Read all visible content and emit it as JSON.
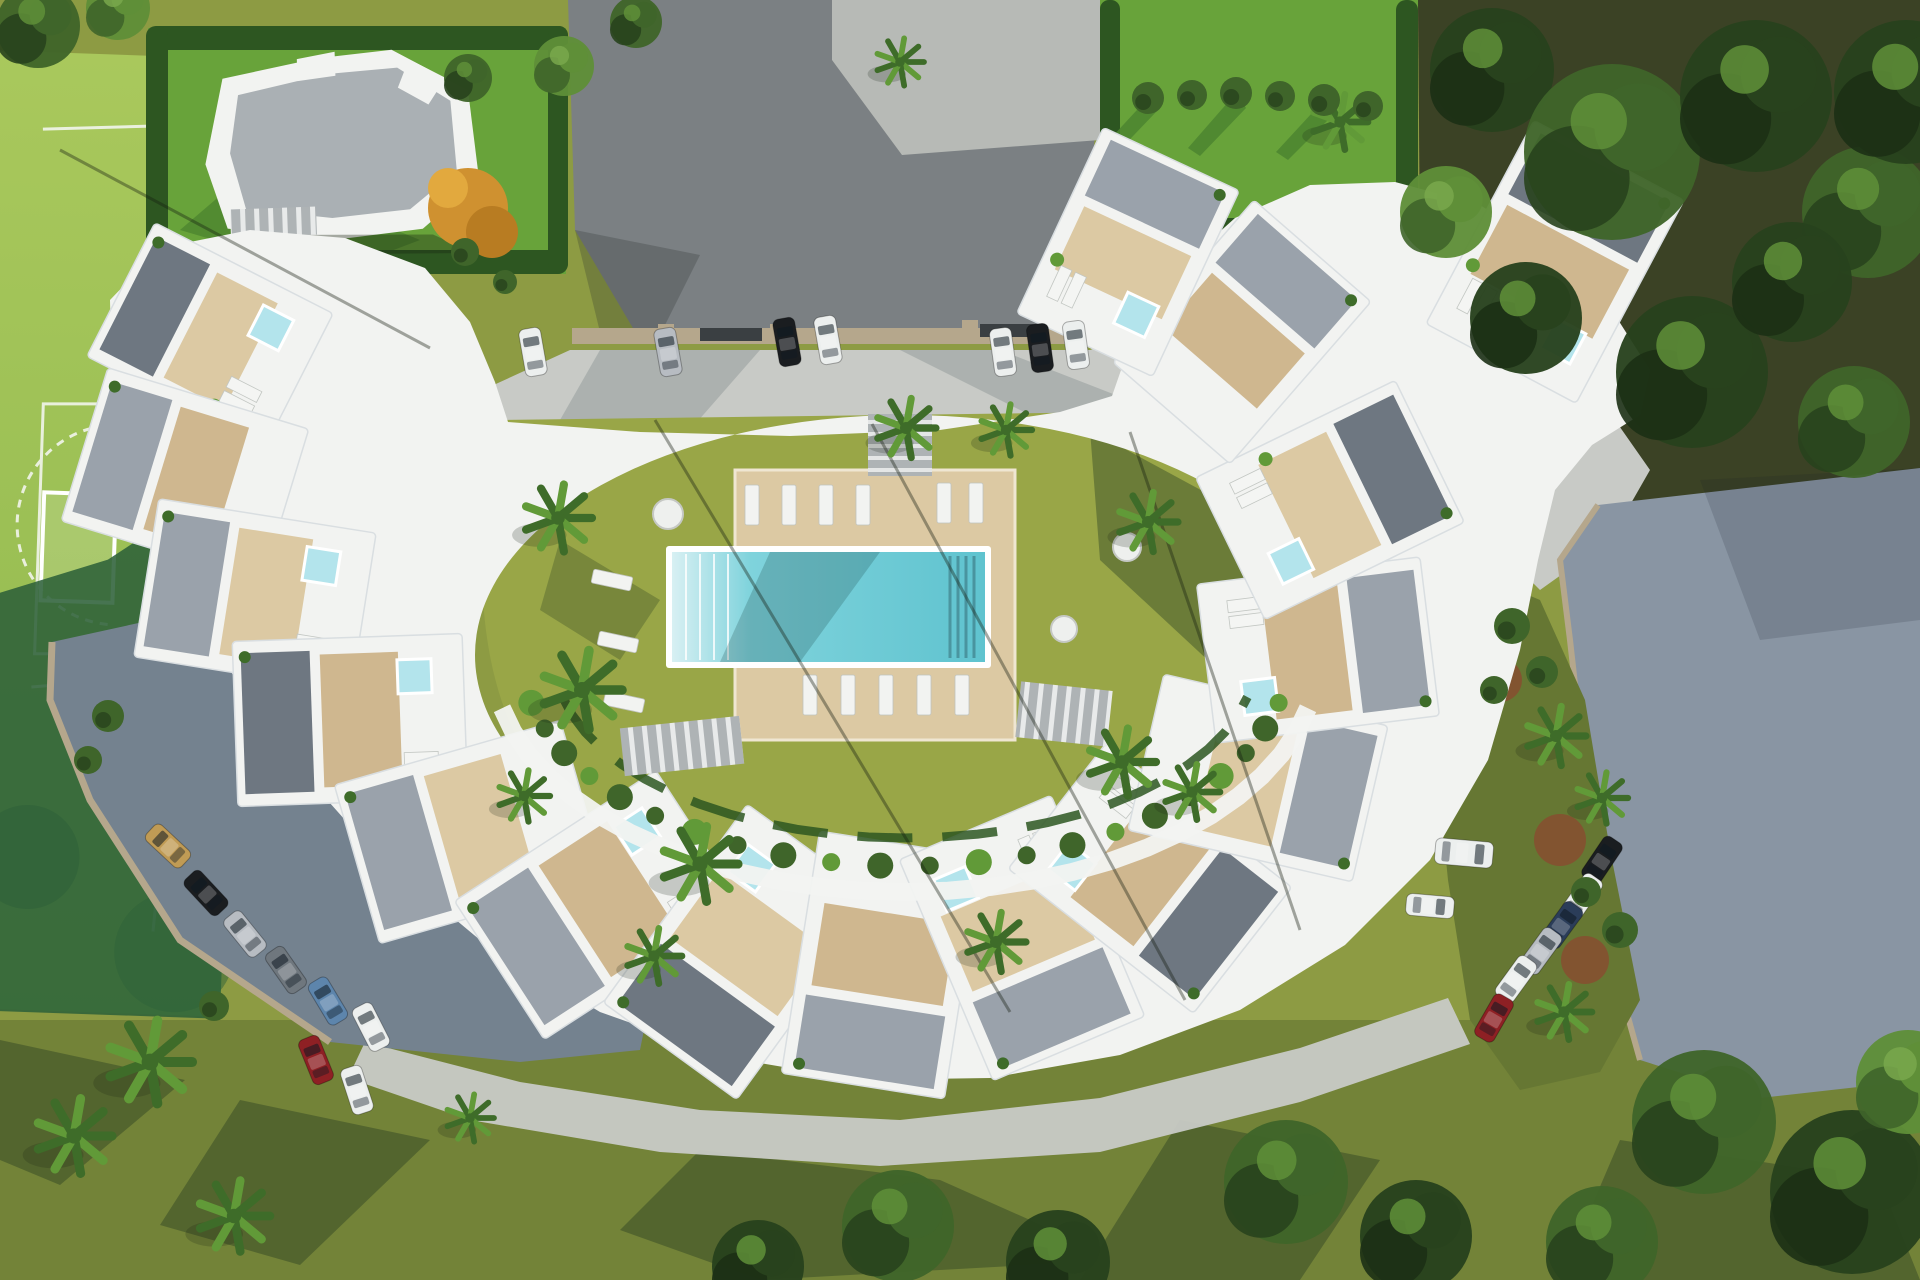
{
  "scene": {
    "title": "Aerial 3D render of a crescent-shaped residential complex with communal pool, gardens, parking areas and sports court",
    "type": "architectural-visualization",
    "elements": [
      "crescent apartment buildings with rooftop terraces and plunge pools",
      "central courtyard lawn with wooden pool deck and swimming pool",
      "sun loungers and round tables",
      "palm trees and mediterranean planting",
      "asphalt driveway and grey parking lots with parked cars",
      "detached neighbour villa with grey roof and hedged garden",
      "five-a-side sports court",
      "mature woodland on the right"
    ]
  },
  "palette": {
    "lawn": "#8d9b43",
    "lawn_dark": "#667733",
    "lawn_shadow": "#46592b",
    "lawn_bright": "#68a33a",
    "lawn_bright_dark": "#4c8530",
    "courtyard_lawn": "#99a647",
    "hedge": "#2d5621",
    "court": "#a3c257",
    "court_shadow": "#2e6139",
    "asphalt": "#7b8083",
    "concrete": "#b7bab6",
    "pavement": "#c8cac6",
    "pavement_shadow": "#9aa0a0",
    "parking": "#74828f",
    "parking_light": "#8995a3",
    "curb": "#b5a78c",
    "building": "#f2f3f1",
    "building_shade": "#d9dee1",
    "roof_gray": "#aab0b4",
    "deck": "#cfb78f",
    "deck_light": "#dcc9a3",
    "gravel": "#9aa2ab",
    "gravel_dark": "#6e7781",
    "pool": "#7fd3dc",
    "pool_deep": "#5fc3cf",
    "pool_shelf": "#d8f0f3",
    "jacuzzi": "#b3e4ec",
    "palm": "#619a38",
    "palm_dark": "#3e6c29",
    "tree_dark": "#28421d",
    "tree_mid": "#3f652a",
    "tree_light": "#5f8f38",
    "forest_ground": "#473f2b",
    "autumn": "#cf9130",
    "terracotta": "#8a4b30",
    "shadow": "rgba(25,35,18,0.45)",
    "car_white": "#ecefee",
    "car_silver": "#b7bcc2",
    "car_black": "#1a1d20",
    "car_tan": "#c09b55",
    "car_blue": "#5d85ac",
    "car_red": "#8e2024",
    "car_darkblue": "#2b3d59",
    "car_gray": "#6f777e"
  },
  "cars": {
    "legend": "x,y,rot(deg),color-key,van?",
    "top_row": [
      {
        "x": 533,
        "y": 352,
        "rot": -10,
        "c": "car_white"
      },
      {
        "x": 668,
        "y": 352,
        "rot": -10,
        "c": "car_silver"
      },
      {
        "x": 787,
        "y": 342,
        "rot": -10,
        "c": "car_black"
      },
      {
        "x": 828,
        "y": 340,
        "rot": -10,
        "c": "car_white"
      },
      {
        "x": 1003,
        "y": 352,
        "rot": -8,
        "c": "car_white"
      },
      {
        "x": 1040,
        "y": 348,
        "rot": -8,
        "c": "car_black"
      },
      {
        "x": 1076,
        "y": 345,
        "rot": -8,
        "c": "car_white"
      }
    ],
    "left_row": [
      {
        "x": 168,
        "y": 846,
        "rot": -47,
        "c": "car_tan"
      },
      {
        "x": 206,
        "y": 893,
        "rot": -43,
        "c": "car_black"
      },
      {
        "x": 245,
        "y": 934,
        "rot": -39,
        "c": "car_silver"
      },
      {
        "x": 286,
        "y": 970,
        "rot": -35,
        "c": "car_gray"
      },
      {
        "x": 328,
        "y": 1001,
        "rot": -31,
        "c": "car_blue"
      },
      {
        "x": 371,
        "y": 1027,
        "rot": -27,
        "c": "car_white"
      },
      {
        "x": 316,
        "y": 1060,
        "rot": -22,
        "c": "car_red"
      },
      {
        "x": 357,
        "y": 1090,
        "rot": -18,
        "c": "car_white"
      }
    ],
    "right_row": [
      {
        "x": 1602,
        "y": 860,
        "rot": 34,
        "c": "car_black"
      },
      {
        "x": 1582,
        "y": 897,
        "rot": 35,
        "c": "car_white"
      },
      {
        "x": 1562,
        "y": 925,
        "rot": 36,
        "c": "car_darkblue"
      },
      {
        "x": 1541,
        "y": 951,
        "rot": 36,
        "c": "car_silver"
      },
      {
        "x": 1516,
        "y": 979,
        "rot": 36,
        "c": "car_white"
      },
      {
        "x": 1494,
        "y": 1018,
        "rot": 30,
        "c": "car_red"
      }
    ],
    "right_lot_loose": [
      {
        "x": 1464,
        "y": 853,
        "rot": 95,
        "c": "car_white",
        "van": true
      },
      {
        "x": 1430,
        "y": 906,
        "rot": 95,
        "c": "car_white"
      }
    ]
  },
  "palms": [
    [
      558,
      518,
      34
    ],
    [
      582,
      690,
      40
    ],
    [
      700,
      864,
      38
    ],
    [
      524,
      796,
      26
    ],
    [
      906,
      428,
      30
    ],
    [
      1006,
      430,
      26
    ],
    [
      1148,
      522,
      30
    ],
    [
      1122,
      762,
      34
    ],
    [
      1192,
      792,
      28
    ],
    [
      996,
      942,
      30
    ],
    [
      654,
      956,
      28
    ],
    [
      150,
      1062,
      42
    ],
    [
      74,
      1136,
      38
    ],
    [
      234,
      1216,
      36
    ],
    [
      470,
      1118,
      24
    ],
    [
      1556,
      736,
      30
    ],
    [
      1602,
      798,
      26
    ],
    [
      1564,
      1012,
      28
    ],
    [
      1340,
      122,
      28
    ],
    [
      900,
      62,
      24
    ]
  ],
  "trees": [
    [
      1492,
      70,
      62,
      0
    ],
    [
      1612,
      152,
      88,
      1
    ],
    [
      1756,
      96,
      76,
      0
    ],
    [
      1868,
      212,
      66,
      1
    ],
    [
      1526,
      318,
      56,
      0
    ],
    [
      1692,
      372,
      76,
      0
    ],
    [
      1854,
      422,
      56,
      1
    ],
    [
      1446,
      212,
      46,
      2
    ],
    [
      1906,
      92,
      72,
      0
    ],
    [
      1792,
      282,
      60,
      0
    ],
    [
      1704,
      1122,
      72,
      1
    ],
    [
      1852,
      1192,
      82,
      0
    ],
    [
      1602,
      1242,
      56,
      1
    ],
    [
      1908,
      1082,
      52,
      2
    ],
    [
      898,
      1226,
      56,
      1
    ],
    [
      1058,
      1262,
      52,
      0
    ],
    [
      1286,
      1182,
      62,
      1
    ],
    [
      1416,
      1236,
      56,
      0
    ],
    [
      758,
      1266,
      46,
      0
    ],
    [
      38,
      26,
      42,
      1
    ],
    [
      118,
      8,
      32,
      2
    ],
    [
      564,
      66,
      30,
      2
    ],
    [
      636,
      22,
      26,
      1
    ],
    [
      468,
      78,
      24,
      1
    ]
  ],
  "bushes": [
    [
      1148,
      98,
      16
    ],
    [
      1192,
      95,
      15
    ],
    [
      1236,
      93,
      16
    ],
    [
      1280,
      96,
      15
    ],
    [
      1324,
      100,
      16
    ],
    [
      1368,
      106,
      15
    ],
    [
      1512,
      626,
      18
    ],
    [
      1542,
      672,
      16
    ],
    [
      1494,
      690,
      14
    ],
    [
      1620,
      930,
      18
    ],
    [
      1586,
      892,
      15
    ],
    [
      108,
      716,
      16
    ],
    [
      88,
      760,
      14
    ],
    [
      214,
      1006,
      15
    ],
    [
      465,
      252,
      14
    ],
    [
      505,
      282,
      12
    ]
  ],
  "loungers": {
    "deck": [
      [
        752,
        505
      ],
      [
        789,
        505
      ],
      [
        826,
        505
      ],
      [
        863,
        505
      ],
      [
        944,
        503
      ],
      [
        976,
        503
      ],
      [
        810,
        695
      ],
      [
        848,
        695
      ],
      [
        886,
        695
      ],
      [
        924,
        695
      ],
      [
        962,
        695
      ]
    ],
    "lawn": [
      [
        612,
        580,
        -78
      ],
      [
        618,
        642,
        -78
      ],
      [
        624,
        702,
        -78
      ]
    ]
  },
  "tables": [
    [
      668,
      514,
      15
    ],
    [
      1127,
      547,
      14
    ],
    [
      1064,
      629,
      13
    ]
  ],
  "buildings": [
    {
      "cx": 210,
      "cy": 335,
      "w": 150,
      "h": 200,
      "rot": -63,
      "j": 1
    },
    {
      "cx": 185,
      "cy": 475,
      "w": 160,
      "h": 210,
      "rot": -73,
      "j": 0
    },
    {
      "cx": 255,
      "cy": 595,
      "w": 160,
      "h": 220,
      "rot": -81,
      "j": 1
    },
    {
      "cx": 350,
      "cy": 720,
      "w": 165,
      "h": 230,
      "rot": -92,
      "j": 1
    },
    {
      "cx": 470,
      "cy": 832,
      "w": 165,
      "h": 235,
      "rot": -106,
      "j": 0
    },
    {
      "cx": 600,
      "cy": 905,
      "w": 165,
      "h": 240,
      "rot": -123,
      "j": 1
    },
    {
      "cx": 742,
      "cy": 952,
      "w": 165,
      "h": 245,
      "rot": -144,
      "j": 1
    },
    {
      "cx": 882,
      "cy": 965,
      "w": 165,
      "h": 245,
      "rot": -171,
      "j": 0
    },
    {
      "cx": 1022,
      "cy": 938,
      "w": 165,
      "h": 240,
      "rot": 157,
      "j": 1
    },
    {
      "cx": 1150,
      "cy": 878,
      "w": 160,
      "h": 235,
      "rot": 128,
      "j": 1
    },
    {
      "cx": 1258,
      "cy": 778,
      "w": 160,
      "h": 230,
      "rot": 103,
      "j": 0
    },
    {
      "cx": 1318,
      "cy": 650,
      "w": 160,
      "h": 225,
      "rot": 83,
      "j": 1
    },
    {
      "cx": 1330,
      "cy": 500,
      "w": 158,
      "h": 222,
      "rot": 64,
      "j": 1
    },
    {
      "cx": 1242,
      "cy": 332,
      "w": 155,
      "h": 215,
      "rot": 41,
      "j": 0
    },
    {
      "cx": 1128,
      "cy": 252,
      "w": 150,
      "h": 205,
      "rot": 25,
      "j": 1
    },
    {
      "cx": 1555,
      "cy": 262,
      "w": 170,
      "h": 230,
      "rot": 28,
      "j": 1
    }
  ],
  "planter_ring": {
    "cx": 905,
    "cy": 660,
    "walk_rx": 412,
    "walk_ry": 232,
    "bush_rx": 382,
    "bush_ry": 206,
    "hedge_rx": 350,
    "hedge_ry": 178,
    "t0": 168,
    "t1": 12,
    "n": 22
  }
}
